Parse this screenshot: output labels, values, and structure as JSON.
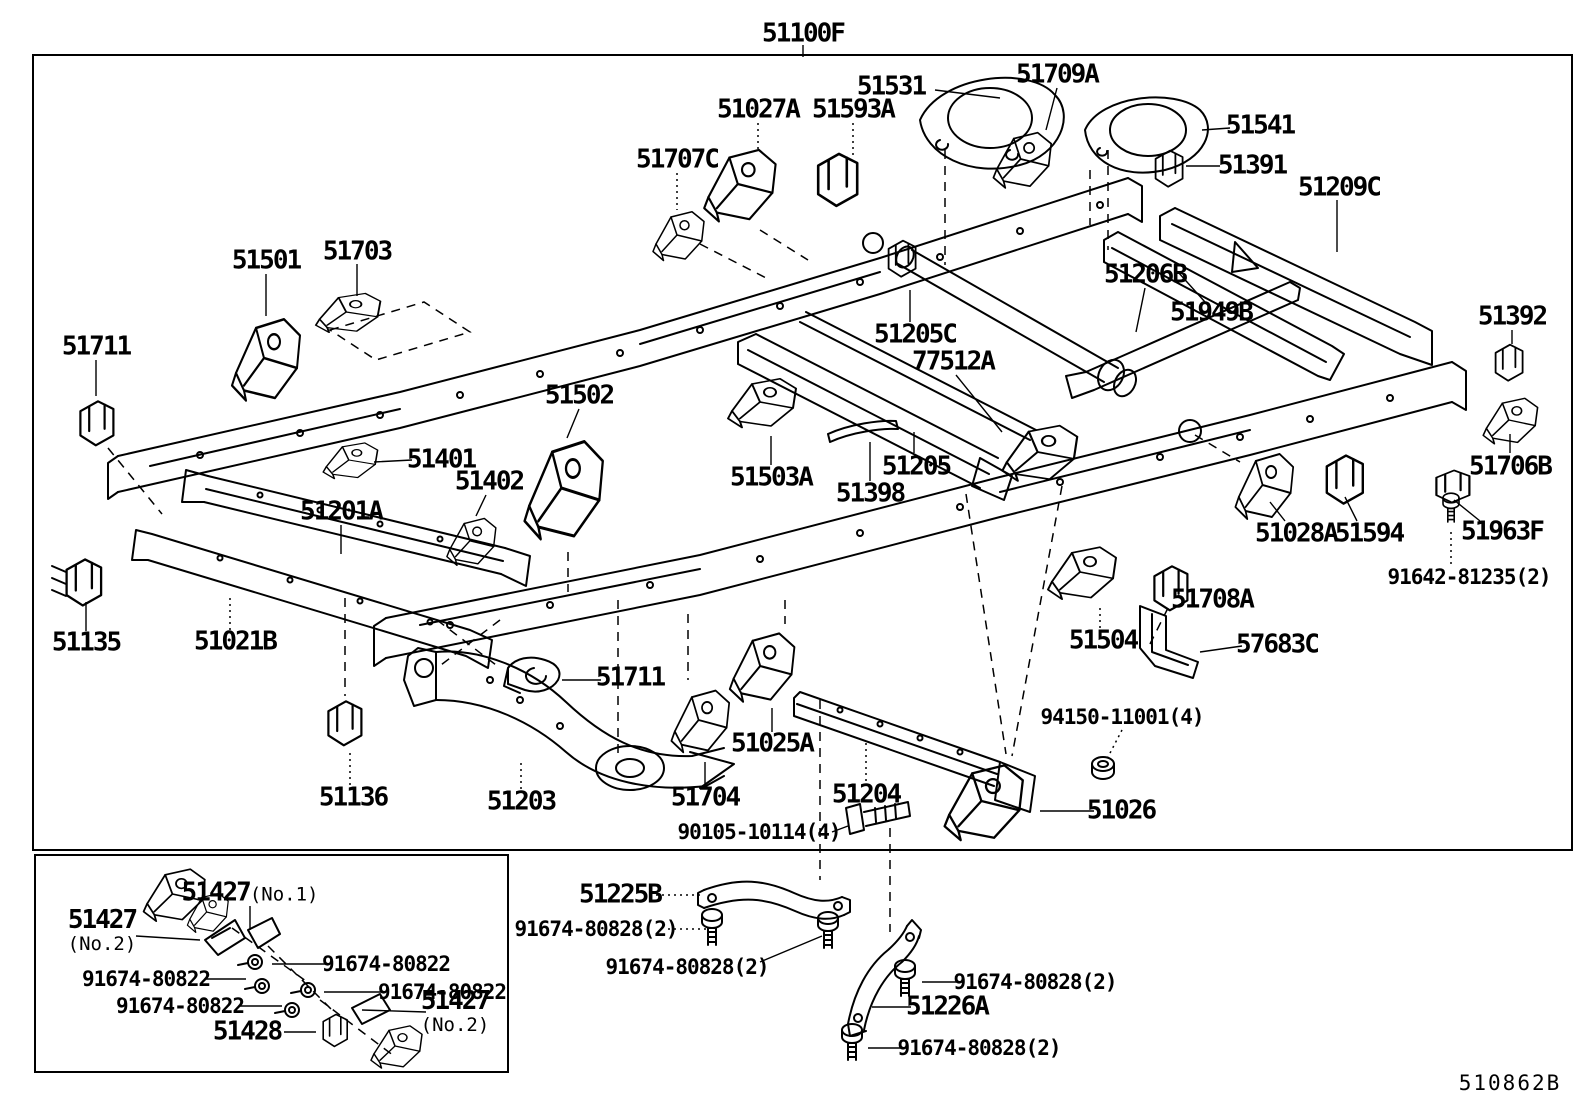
{
  "page": {
    "background": "#ffffff",
    "ink": "#000000",
    "drawing_ref": "510862B"
  },
  "diagram": {
    "assembly_number": "51100F",
    "description": "frame-parts-exploded-diagram",
    "labels": [
      {
        "text": "51100F",
        "x": 803,
        "y": 34
      },
      {
        "text": "51531",
        "x": 891,
        "y": 87
      },
      {
        "text": "51709A",
        "x": 1057,
        "y": 75
      },
      {
        "text": "51027A",
        "x": 758,
        "y": 110
      },
      {
        "text": "51593A",
        "x": 853,
        "y": 110
      },
      {
        "text": "51707C",
        "x": 677,
        "y": 160
      },
      {
        "text": "51541",
        "x": 1260,
        "y": 126
      },
      {
        "text": "51391",
        "x": 1252,
        "y": 166
      },
      {
        "text": "51209C",
        "x": 1339,
        "y": 188
      },
      {
        "text": "51501",
        "x": 266,
        "y": 261
      },
      {
        "text": "51703",
        "x": 357,
        "y": 252
      },
      {
        "text": "51711",
        "x": 96,
        "y": 347
      },
      {
        "text": "51206B",
        "x": 1145,
        "y": 275
      },
      {
        "text": "51949B",
        "x": 1211,
        "y": 313
      },
      {
        "text": "51392",
        "x": 1512,
        "y": 317
      },
      {
        "text": "51205C",
        "x": 915,
        "y": 335
      },
      {
        "text": "77512A",
        "x": 953,
        "y": 362
      },
      {
        "text": "51502",
        "x": 579,
        "y": 396
      },
      {
        "text": "51401",
        "x": 441,
        "y": 460
      },
      {
        "text": "51402",
        "x": 489,
        "y": 482
      },
      {
        "text": "51503A",
        "x": 771,
        "y": 478
      },
      {
        "text": "51205",
        "x": 916,
        "y": 467
      },
      {
        "text": "51398",
        "x": 870,
        "y": 494
      },
      {
        "text": "51706B",
        "x": 1510,
        "y": 467
      },
      {
        "text": "51201A",
        "x": 341,
        "y": 512
      },
      {
        "text": "51028A",
        "x": 1296,
        "y": 534
      },
      {
        "text": "51594",
        "x": 1369,
        "y": 534
      },
      {
        "text": "51963F",
        "x": 1502,
        "y": 532
      },
      {
        "text": "91642-81235(2)",
        "x": 1469,
        "y": 577,
        "size": "md"
      },
      {
        "text": "51135",
        "x": 86,
        "y": 643
      },
      {
        "text": "51021B",
        "x": 235,
        "y": 642
      },
      {
        "text": "51708A",
        "x": 1212,
        "y": 600
      },
      {
        "text": "51504",
        "x": 1103,
        "y": 641
      },
      {
        "text": "57683C",
        "x": 1277,
        "y": 645
      },
      {
        "text": "51136",
        "x": 353,
        "y": 798
      },
      {
        "text": "51711",
        "x": 630,
        "y": 678
      },
      {
        "text": "51203",
        "x": 521,
        "y": 802
      },
      {
        "text": "51704",
        "x": 705,
        "y": 798
      },
      {
        "text": "51025A",
        "x": 772,
        "y": 744
      },
      {
        "text": "51204",
        "x": 866,
        "y": 795
      },
      {
        "text": "90105-10114(4)",
        "x": 759,
        "y": 832,
        "size": "md"
      },
      {
        "text": "94150-11001(4)",
        "x": 1122,
        "y": 717,
        "size": "md"
      },
      {
        "text": "51026",
        "x": 1121,
        "y": 811
      },
      {
        "text": "51225B",
        "x": 620,
        "y": 895
      },
      {
        "text": "91674-80828(2)",
        "x": 596,
        "y": 929,
        "size": "md"
      },
      {
        "text": "91674-80828(2)",
        "x": 687,
        "y": 967,
        "size": "md"
      },
      {
        "text": "51226A",
        "x": 947,
        "y": 1007
      },
      {
        "text": "91674-80828(2)",
        "x": 1035,
        "y": 982,
        "size": "md"
      },
      {
        "text": "91674-80828(2)",
        "x": 979,
        "y": 1048,
        "size": "md"
      },
      {
        "text": "51427",
        "x": 250,
        "y": 893,
        "sub": "(No.1)",
        "subpos": "right"
      },
      {
        "text": "51427",
        "x": 102,
        "y": 931,
        "sub": "(No.2)",
        "subpos": "below"
      },
      {
        "text": "91674-80822",
        "x": 386,
        "y": 964,
        "size": "md"
      },
      {
        "text": "91674-80822",
        "x": 146,
        "y": 979,
        "size": "md"
      },
      {
        "text": "91674-80822",
        "x": 442,
        "y": 992,
        "size": "md"
      },
      {
        "text": "91674-80822",
        "x": 180,
        "y": 1006,
        "size": "md"
      },
      {
        "text": "51428",
        "x": 247,
        "y": 1032
      },
      {
        "text": "51427",
        "x": 455,
        "y": 1012,
        "sub": "(No.2)",
        "subpos": "below"
      }
    ]
  }
}
